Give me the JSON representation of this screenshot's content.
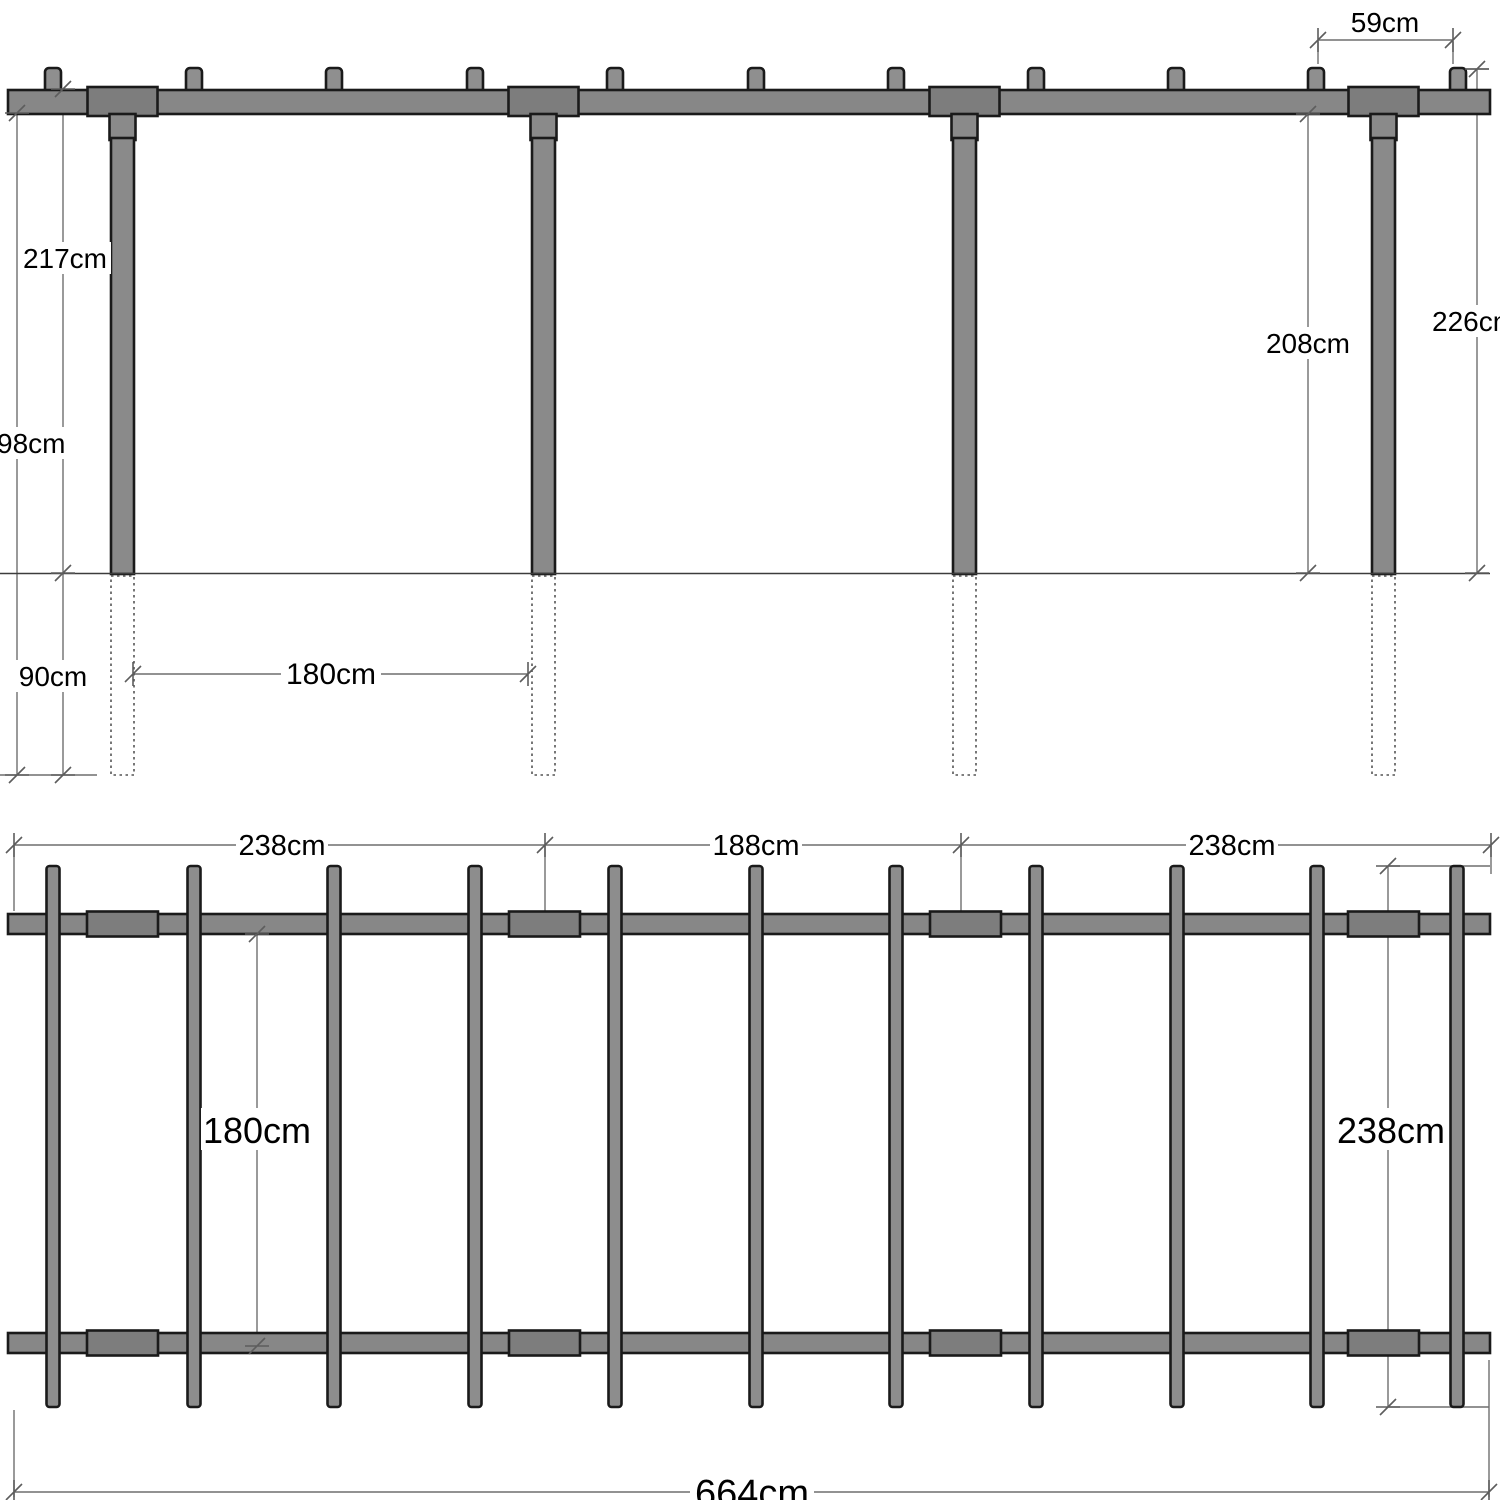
{
  "diagram_title": "Pergola construction drawing — front elevation and plan view",
  "structure": {
    "posts_count": 4,
    "rafters_count": 11,
    "plan_beams_count": 2,
    "member_fill_color": "#878787",
    "joint_block_color": "#7d7d7d",
    "outline_color": "#1a1a1a",
    "dimension_line_color": "#6f6f6f"
  },
  "front_view": {
    "dimensions": {
      "spacing_59": "59cm",
      "height_217": "217cm",
      "height_208": "208cm",
      "height_226": "226cm",
      "buried_98": "98cm",
      "buried_90": "90cm",
      "span_180": "180cm"
    }
  },
  "plan_view": {
    "dimensions": {
      "bay_left_238": "238cm",
      "bay_mid_188": "188cm",
      "bay_right_238": "238cm",
      "width_180": "180cm",
      "depth_238": "238cm",
      "total_664": "664cm"
    }
  }
}
